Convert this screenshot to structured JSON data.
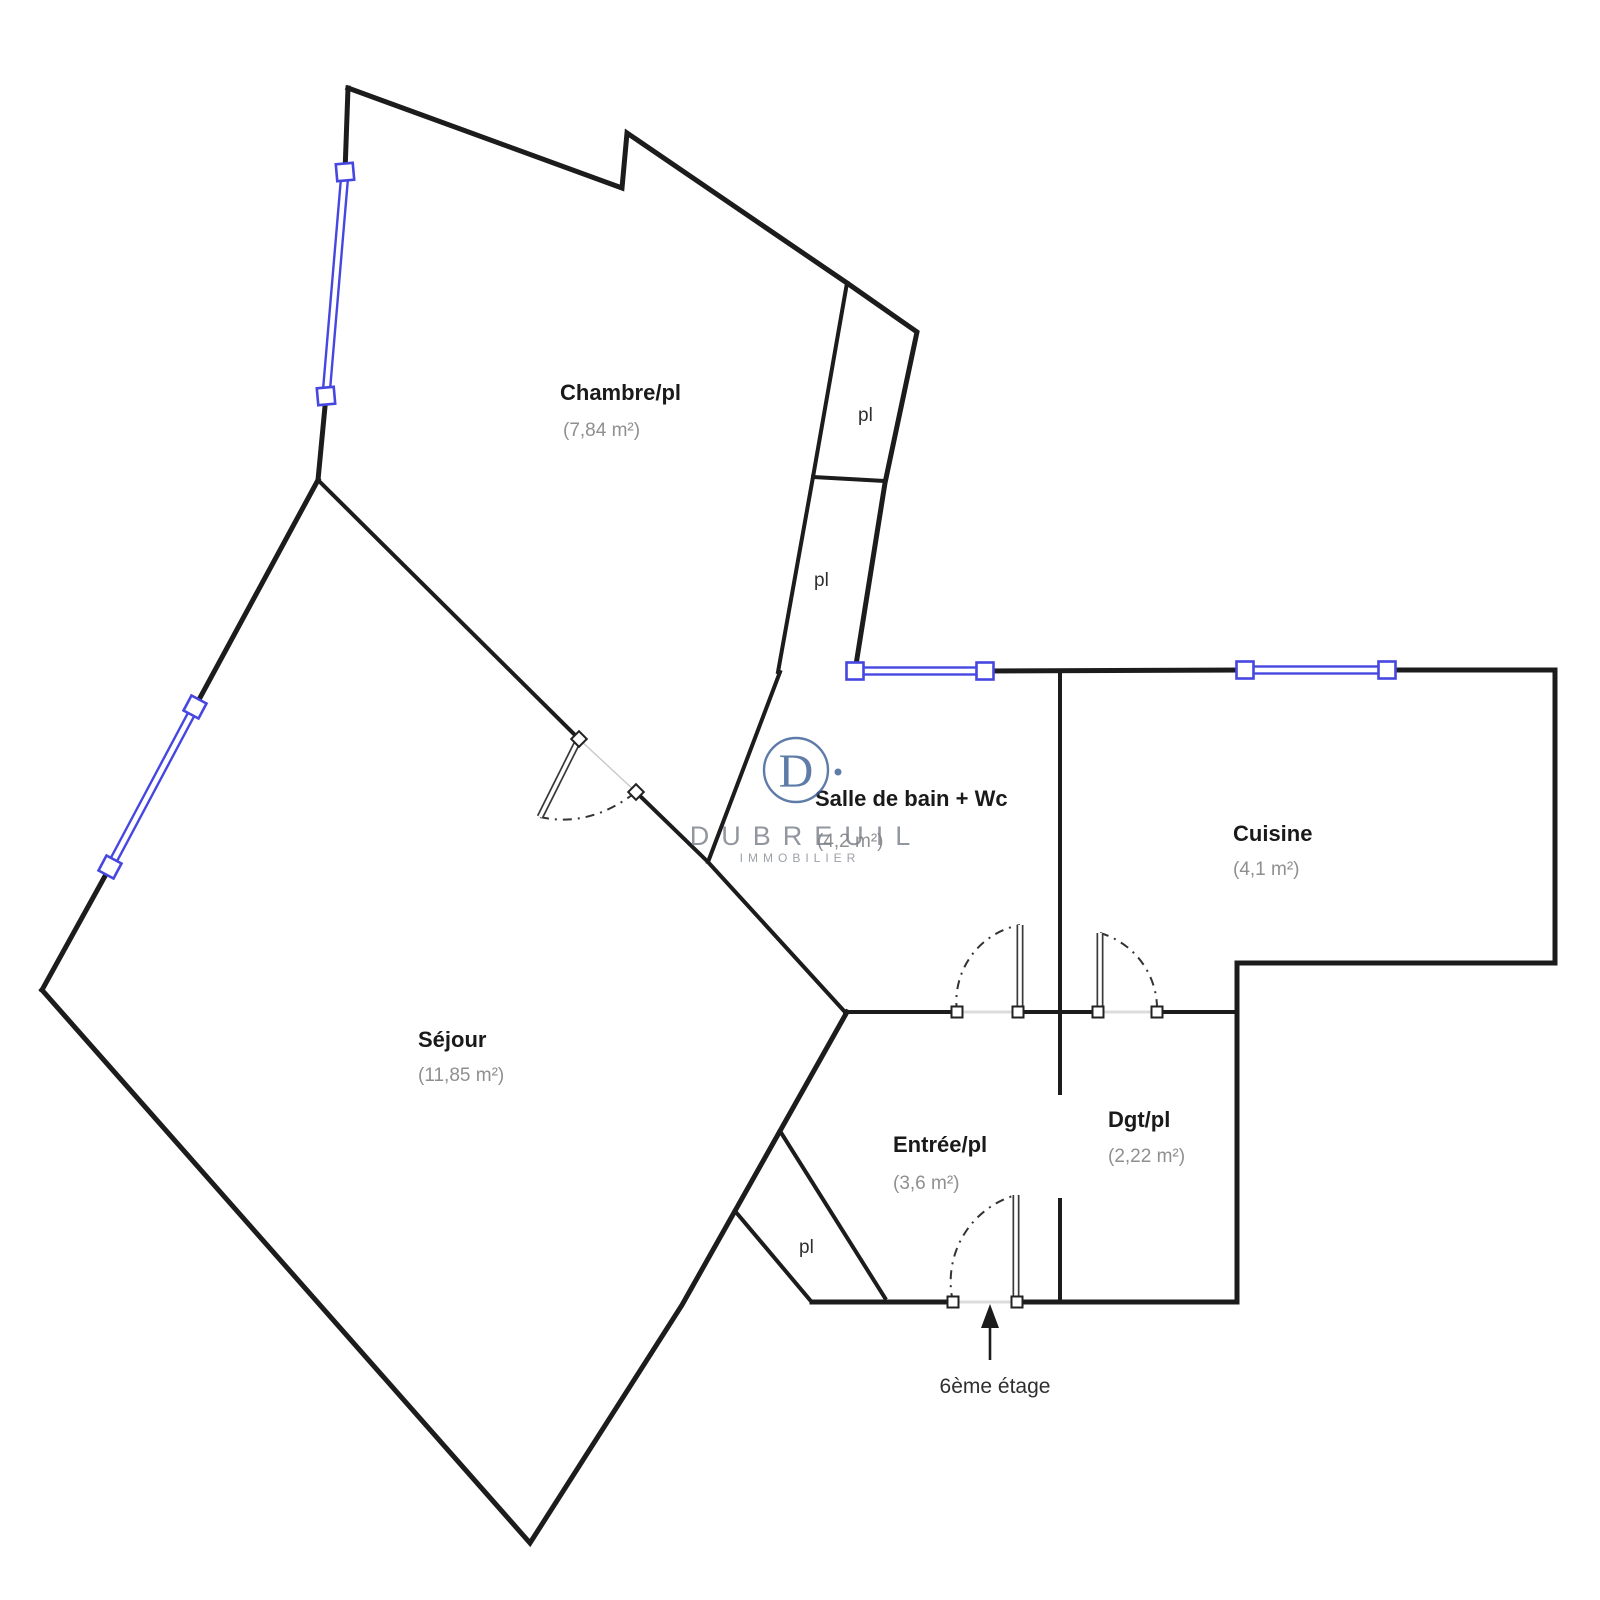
{
  "rooms": {
    "chambre": {
      "name": "Chambre/pl",
      "area": "(7,84 m²)"
    },
    "salle_de_bain": {
      "name": "Salle de bain + Wc",
      "area": "(4,2 m²)"
    },
    "cuisine": {
      "name": "Cuisine",
      "area": "(4,1 m²)"
    },
    "sejour": {
      "name": "Séjour",
      "area": "(11,85 m²)"
    },
    "entree": {
      "name": "Entrée/pl",
      "area": "(3,6 m²)"
    },
    "degagement": {
      "name": "Dgt/pl",
      "area": "(2,22 m²)"
    }
  },
  "closets": {
    "upper": "pl",
    "middle": "pl",
    "entrance": "pl"
  },
  "floor_note": "6ème étage",
  "watermark": {
    "initial": "D",
    "brand": "DUBREUIL",
    "tagline": "IMMOBILIER"
  },
  "colors": {
    "wall": "#1c1c1c",
    "window_blue": "#4646e0",
    "watermark_blue": "#3c6096",
    "area_text_gray": "#8f8f8f"
  }
}
